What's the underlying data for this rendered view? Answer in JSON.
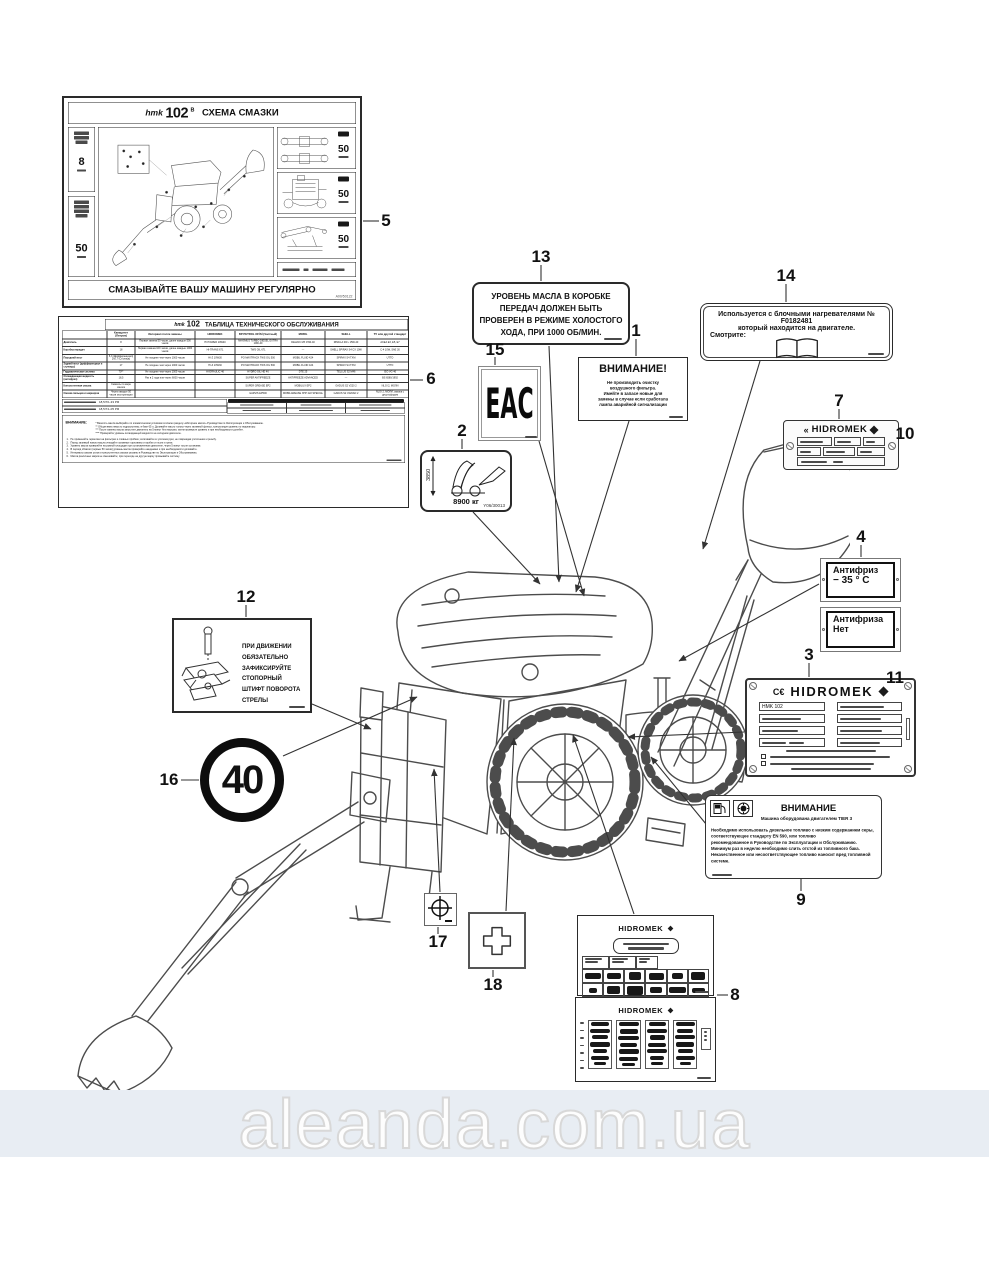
{
  "page": {
    "watermark": "aleanda.com.ua"
  },
  "callouts": [
    "1",
    "2",
    "3",
    "4",
    "5",
    "6",
    "7",
    "8",
    "9",
    "10",
    "11",
    "12",
    "13",
    "14",
    "15",
    "16",
    "17",
    "18"
  ],
  "lube": {
    "brand": "hmk",
    "model": "102",
    "suffix": "B",
    "title": "СХЕМА СМАЗКИ",
    "footer": "СМАЗЫВАЙТЕ ВАШУ МАШИНУ РЕГУЛЯРНО",
    "left_top": "8",
    "left_bottom": "50",
    "right": [
      "50",
      "50",
      "50"
    ],
    "code": "A00/50122"
  },
  "maint": {
    "brand": "hmk",
    "model": "102",
    "title": "ТАБЛИЦА ТЕХНИЧЕСКОГО ОБСЛУЖИВАНИЯ",
    "columns": [
      "",
      "Капацитет (Литров)",
      "Интервал после замены",
      "HIDROMEK",
      "BP PETROL OFİSİ (Частный)",
      "MOBIL",
      "SHELL",
      "ТУ или другой стандарт"
    ],
    "rows": [
      [
        "Двигатель",
        "8",
        "Первая замена 50 часов, далее каждые 500 часов",
        "HI POWER 10W40",
        "MAXIMUS TURBO DIESEL EXTRA 10W-40",
        "DELVAC MX 15W-40",
        "RIMULA R4 L 15W-40",
        "ACEA E3, E5, E7"
      ],
      [
        "Коробка передач",
        "18",
        "Первая замена 100 часов, далее каждые 1000 часов",
        "HI-TRANS 671",
        "TWS OIL 671",
        "—",
        "SHELL SPIRAX S4 CX 10W",
        "C-4 10W, SAE 30"
      ],
      [
        "Передний мост",
        "6,3 (Дифференциал) 2x0,7 (Ступица)",
        "Не позднее чем через 1000 часов",
        "HI-Z 10W30",
        "PO MAXTRACK TWS OIL 500",
        "MOBIL FLUID 424",
        "SPIRAX S4 TXM",
        "UTTO"
      ],
      [
        "Задний мост (дифференциал и ступицы)",
        "17",
        "Не позднее чем через 1000 часов",
        "HI-Z 10W30",
        "PO MAXTRACK TWS OIL 500",
        "MOBIL FLUID 424",
        "SPIRAX S4 TXM",
        "UTTO"
      ],
      [
        "Гидравлическая система",
        "70**",
        "Не позднее чем через 1000 часов",
        "HI-DRAULIC 46",
        "HYDRO OIL HD 46",
        "DTE 25",
        "TELLUS S2 M46",
        "ISO VG 46"
      ],
      [
        "Охлаждающая жидкость (антифриз)",
        "18,5",
        "Раз в 2 года или через 6000 часов",
        "",
        "SUPER ANTIFREEZE",
        "ANTIFREEZE ADVANCED",
        "—",
        "BS 6580/1992"
      ],
      [
        "Консистентная смазка",
        "Смазать по мере износа",
        "",
        "",
        "SUPER GREASE EP2",
        "MOBILUX EP2",
        "GADUS S2 V220 2",
        "NLGI 2, МОЛИ"
      ],
      [
        "Смазка пальцев и шарниров",
        "Через каждые 50 часов эксплуатации",
        "",
        "",
        "GARVIS EP500",
        "MOBILGREASE XHP 222 SPECIAL",
        "GADUS S2 V220AD 2",
        "NLGI 2, МОЛИ, смазка с дисульфидом"
      ]
    ],
    "fuel": [
      "18,5/70–33 РФ",
      "18,5/74–05 РФ"
    ],
    "notes_title": "ВНИМАНИЕ:",
    "star_notes": [
      "*  Вязкость масла выбирайте по климатическим условиям согласно разделу «Моторное масло» Руководства по Эксплуатации и Обслуживанию.",
      "**  Общая вместимость гидросистемы; в баке 65 л. Доливайте масло только через заливной фильтр, контролируя уровень по индикатору.",
      "***  После замены масла запустите двигатель на 5 минут без нагрузки, затем проверьте уровень и при необходимости долейте.",
      "****  Проверяйте уровень охлаждающей жидкости на холодном двигателе."
    ],
    "num_notes": [
      "Не применяйте герметики на фильтрах и сливных пробках; затягивайте их усилием руки, не повреждая уплотнения и резьбу.",
      "Перед заливкой нового масла очищайте заливные горловины и пробки от пыли и грязи.",
      "Уровень масла проверяйте на ровной площадке при остановленном двигателе, через 5 минут после остановки.",
      "В период обкатки (первые 50 часов) уровень масла проверяйте ежедневно и при необходимости доливайте.",
      "Интервалы смазки узлов и консистентных смазок указаны в Руководстве по Эксплуатации и Обслуживанию.",
      "Масла различных марок не смешивайте; при переходе на другую марку промывайте систему."
    ]
  },
  "gearbox": {
    "lines": [
      "УРОВЕНЬ МАСЛА В КОРОБКЕ",
      "ПЕРЕДАЧ ДОЛЖЕН БЫТЬ",
      "ПРОВЕРЕН В РЕЖИМЕ ХОЛОСТОГО",
      "ХОДА, ПРИ 1000 ОБ/МИН."
    ]
  },
  "filter_warn": {
    "title": "ВНИМАНИЕ!",
    "lines": [
      "Не производить очистку",
      "воздушного фильтра.",
      "Имейте в запасе новые для",
      "замены в случае если сработала",
      "лампа аварийной сигнализации"
    ]
  },
  "heater": {
    "line1": "Используется с блочными нагревателями № F0182481",
    "line2": "который находится на двигателе.",
    "see": "Смотрите:"
  },
  "eac": {
    "letters": "ЕАС"
  },
  "transport": {
    "height": "3850",
    "weight": "8900 кг",
    "code": "Y06/30013"
  },
  "plate7": {
    "ce": "«",
    "brand": "HIDROMEK"
  },
  "antifreeze": {
    "a1": "Антифриз",
    "a2": "− 35 ° C",
    "b1": "Антифриза",
    "b2": "Нет"
  },
  "plate3": {
    "ce": "C€",
    "brand": "HIDROMEK",
    "model": "HMK 102"
  },
  "pin": {
    "lines": [
      "ПРИ ДВИЖЕНИИ ОБЯЗАТЕЛЬНО",
      "ЗАФИКСИРУЙТЕ СТОПОРНЫЙ",
      "ШТИФТ ПОВОРОТА СТРЕЛЫ"
    ]
  },
  "speed": {
    "value": "40"
  },
  "tier": {
    "title": "ВНИМАНИЕ",
    "subtitle": "Машина оборудована двигателем TIER 3",
    "body": [
      "Необходимо использовать дизельное топливо с низким содержанием серы, соответствующее стандарту EN 590, или топливо",
      "рекомендованное в Руководстве по Эксплуатации и Обслуживанию.",
      "Минимум раз в неделю необходимо слить отстой из топливного бака.",
      "Некачественное или несоответствующее топливо наносит вред топливной системе."
    ]
  },
  "hm8a": {
    "brand": "HIDROMEK"
  },
  "hm8b": {
    "brand": "HIDROMEK"
  }
}
